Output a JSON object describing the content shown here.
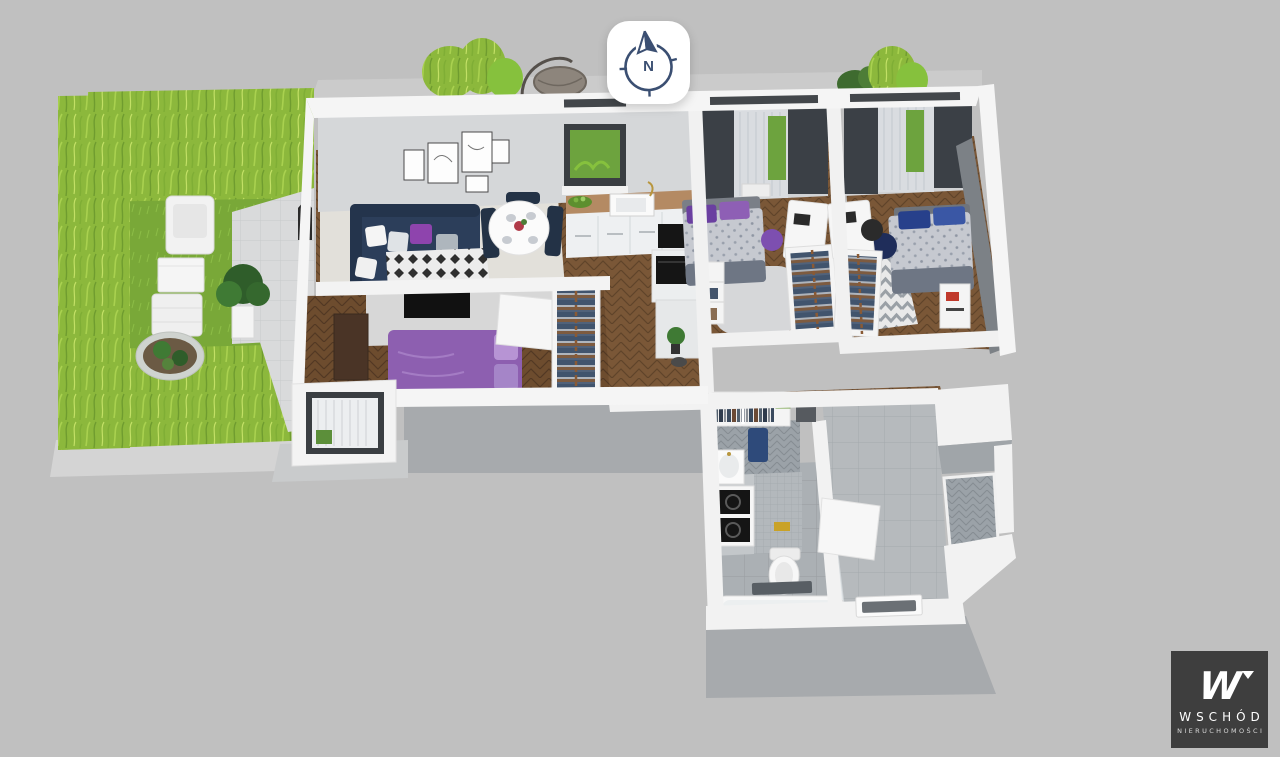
{
  "compass": {
    "letter": "N"
  },
  "logo": {
    "mark": "W",
    "brand": "WSCHÓD",
    "tagline": "NIERUCHOMOŚCI"
  },
  "colors": {
    "background": "#c0c0c0",
    "cut_shadow": "#a7aaad",
    "wall_white": "#f4f4f4",
    "wall_face_gray": "#d5d7d9",
    "hedge_green": "#8cb83c",
    "lawn_green": "#79a838",
    "terrace_paving": "#d9dadb",
    "wood_floor": "#7a5737",
    "tile_gray": "#b6babd",
    "sofa_navy": "#2c3e5a",
    "master_bed_purple": "#8d5fb0",
    "pillow_purple": "#8e44ad",
    "bed_linen_gray": "#c6c9d0",
    "pillow_navy": "#27408b",
    "curtain_dark": "#3b4046",
    "window_green": "#6da33e",
    "kitchen_counter_wood": "#b48a63",
    "appliance_black": "#151515",
    "compass_navy": "#3b4f72",
    "logo_background": "#3e3e3e",
    "logo_text": "#ffffff"
  },
  "scene": {
    "type": "3d-floor-plan-render",
    "rooms": [
      "garden-terrace",
      "living-room",
      "kitchen-dining",
      "master-bedroom",
      "bedroom-2",
      "bedroom-3",
      "hallway",
      "bathroom",
      "entrance-hall"
    ],
    "objects": {
      "garden-terrace": [
        "hedge",
        "lawn",
        "paved-patio",
        "outdoor-armchair",
        "outdoor-table",
        "outdoor-bench",
        "potted-plant",
        "flower-bed",
        "lantern",
        "hanging-chair",
        "bushes"
      ],
      "living-room": [
        "corner-sofa",
        "throw-pillows",
        "wall-art-frames",
        "tv",
        "diamond-rug",
        "window"
      ],
      "kitchen-dining": [
        "dining-table",
        "dining-chairs",
        "kitchen-counter",
        "sink",
        "cooktop",
        "oven",
        "fruit-bowl",
        "tall-cabinet"
      ],
      "master-bedroom": [
        "double-bed",
        "dresser",
        "tv-partition-wall",
        "open-wardrobe",
        "balcony-door",
        "door"
      ],
      "bedroom-2": [
        "single-bed",
        "desk",
        "desk-chair",
        "open-wardrobe",
        "bookshelf",
        "fluffy-rug",
        "curtained-window"
      ],
      "bedroom-3": [
        "single-bed",
        "desk",
        "desk-chair",
        "open-wardrobe",
        "chevron-rug",
        "nightstand",
        "pouf",
        "curtained-window"
      ],
      "bathroom": [
        "wash-basin",
        "washer-dryer-column",
        "toilet",
        "bathtub",
        "shower-screen",
        "towel",
        "bath-mat",
        "door"
      ],
      "hallway": [
        "coat-wardrobe",
        "entrance-door",
        "doormat",
        "tiled-floor"
      ]
    }
  }
}
